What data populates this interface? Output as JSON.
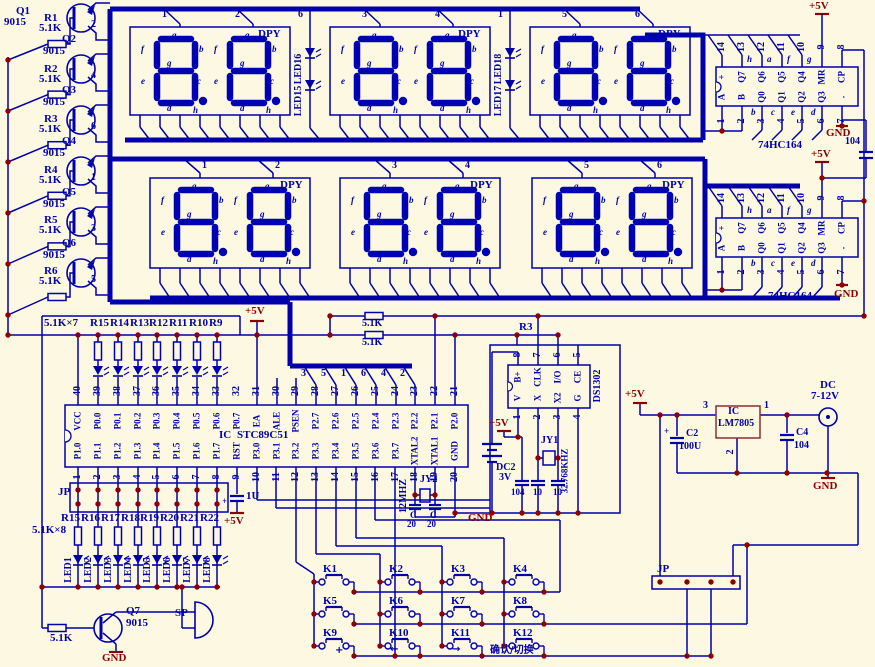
{
  "background": "#fcf8e2",
  "wire_color": "#0000aa",
  "segment_color": "#0000b4",
  "power_color": "#8b0000",
  "displays": {
    "dpy": "DPY",
    "segment_letters": [
      "a",
      "f",
      "b",
      "g",
      "e",
      "c",
      "d",
      "h"
    ],
    "row1_pin_numbers": [
      "1",
      "2",
      "3",
      "4",
      "5",
      "6"
    ],
    "row2_pin_numbers": [
      "1",
      "2",
      "3",
      "4",
      "5",
      "6"
    ],
    "colon1_number": "6",
    "colon2_number": "1",
    "colon1_leds": [
      "LED16",
      "LED15"
    ],
    "colon2_leds": [
      "LED18",
      "LED17"
    ]
  },
  "shift_register": {
    "name": "74HC164",
    "top_pin_numbers": [
      "14",
      "13",
      "12",
      "11",
      "10",
      "9",
      "8"
    ],
    "bottom_pin_numbers": [
      "1",
      "2",
      "3",
      "4",
      "5",
      "6",
      "7"
    ],
    "top_labels": [
      "+",
      "Q7",
      "Q6",
      "Q5",
      "Q4",
      "MR",
      "CP"
    ],
    "bottom_labels": [
      "A",
      "B",
      "Q0",
      "Q1",
      "Q2",
      "Q3",
      "."
    ],
    "top_letters": [
      "h",
      "a",
      "f",
      "g"
    ],
    "bottom_letters": [
      "b",
      "c",
      "e",
      "d"
    ],
    "vcc": "+5V",
    "gnd": "GND",
    "cap": "104"
  },
  "mcu": {
    "ic": "IC",
    "name": "STC89C51",
    "top_pin_numbers": [
      "40",
      "39",
      "38",
      "37",
      "36",
      "35",
      "34",
      "33",
      "32",
      "31",
      "30",
      "29",
      "28",
      "27",
      "26",
      "25",
      "24",
      "23",
      "22",
      "21"
    ],
    "top_labels": [
      "VCC",
      "P0.0",
      "P0.1",
      "P0.2",
      "P0.3",
      "P0.4",
      "P0.5",
      "P0.6",
      "P0.7",
      "EA",
      "ALE",
      "PSEN",
      "P2.7",
      "P2.6",
      "P2.5",
      "P2.4",
      "P2.3",
      "P2.2",
      "P2.1",
      "P2.0"
    ],
    "bottom_pin_numbers": [
      "1",
      "2",
      "3",
      "4",
      "5",
      "6",
      "7",
      "8",
      "9",
      "10",
      "11",
      "12",
      "13",
      "14",
      "15",
      "16",
      "17",
      "18",
      "19",
      "20"
    ],
    "bottom_labels": [
      "P1.0",
      "P1.1",
      "P1.2",
      "P1.3",
      "P1.4",
      "P1.5",
      "P1.6",
      "P1.7",
      "RST",
      "P3.0",
      "P3.1",
      "P3.2",
      "P3.3",
      "P3.4",
      "P3.5",
      "P3.6",
      "P3.7",
      "XTAL2",
      "XTAL1",
      "GND"
    ],
    "select_numbers": [
      "3",
      "5",
      "1",
      "6",
      "4",
      "2"
    ],
    "ea_vcc": "+5V"
  },
  "driver_bank": {
    "transistors": [
      "Q1",
      "Q2",
      "Q3",
      "Q4",
      "Q5",
      "Q6"
    ],
    "model": "9015",
    "resistors": [
      "R1",
      "R2",
      "R3",
      "R4",
      "R5",
      "R6"
    ],
    "value": "5.1K",
    "wire_numbers": [
      "2",
      "4",
      "6",
      "1",
      "3",
      "5"
    ]
  },
  "p0_network": {
    "title": "5.1K×7",
    "resistors": [
      "R15",
      "R14",
      "R13",
      "R12",
      "R11",
      "R10",
      "R9"
    ],
    "vcc": "+5V"
  },
  "pullups": {
    "r_top": "5.1K",
    "r_bottom": "5.1K",
    "r3": "R3"
  },
  "reset": {
    "cap": "1U",
    "vcc": "+5V",
    "plus": "+"
  },
  "xtal": {
    "name": "JY2",
    "freq": "12MHZ",
    "cap_c": "C",
    "cap_v": "20"
  },
  "rtc": {
    "name": "DS1302",
    "top_pin_numbers": [
      "8",
      "7",
      "6",
      "5"
    ],
    "bottom_pin_numbers": [
      "1",
      "2",
      "3",
      "4"
    ],
    "top_labels": [
      "B+",
      "CLK",
      "I/O",
      "CE"
    ],
    "bottom_labels": [
      "V",
      "X",
      "X2",
      "G"
    ],
    "vcc": "+5V",
    "battery_name": "DC2",
    "battery_v": "3V",
    "crystal": "JY1",
    "freq": "32.768KHZ",
    "caps": [
      "104",
      "10",
      "10"
    ],
    "gnd": "GND"
  },
  "power": {
    "vcc": "+5V",
    "c2_name": "C2",
    "c2_value": "100U",
    "plus": "+",
    "ic": "IC",
    "ic_name": "LM7805",
    "pin_in": "3",
    "pin_out": "1",
    "pin_gnd": "2",
    "c4_name": "C4",
    "c4_value": "104",
    "jack_name": "DC",
    "jack_range": "7-12V",
    "gnd": "GND"
  },
  "led_bank": {
    "jp": "JP",
    "title": "5.1K×8",
    "resistors": [
      "R15",
      "R16",
      "R17",
      "R18",
      "R19",
      "R20",
      "R21",
      "R22"
    ],
    "leds": [
      "LED1",
      "LED2",
      "LED3",
      "LED4",
      "LED5",
      "LED6",
      "LED7",
      "LED8"
    ]
  },
  "speaker_driver": {
    "q": "Q7",
    "model": "9015",
    "r": "5.1K",
    "sp": "SP",
    "gnd": "GND"
  },
  "keypad": {
    "keys": [
      "K1",
      "K2",
      "K3",
      "K4",
      "K5",
      "K6",
      "K7",
      "K8",
      "K9",
      "K10",
      "K11",
      "K12"
    ],
    "annotations": [
      "+",
      "←",
      "→",
      "确认/切换"
    ]
  },
  "jp2": {
    "jp": "JP"
  }
}
